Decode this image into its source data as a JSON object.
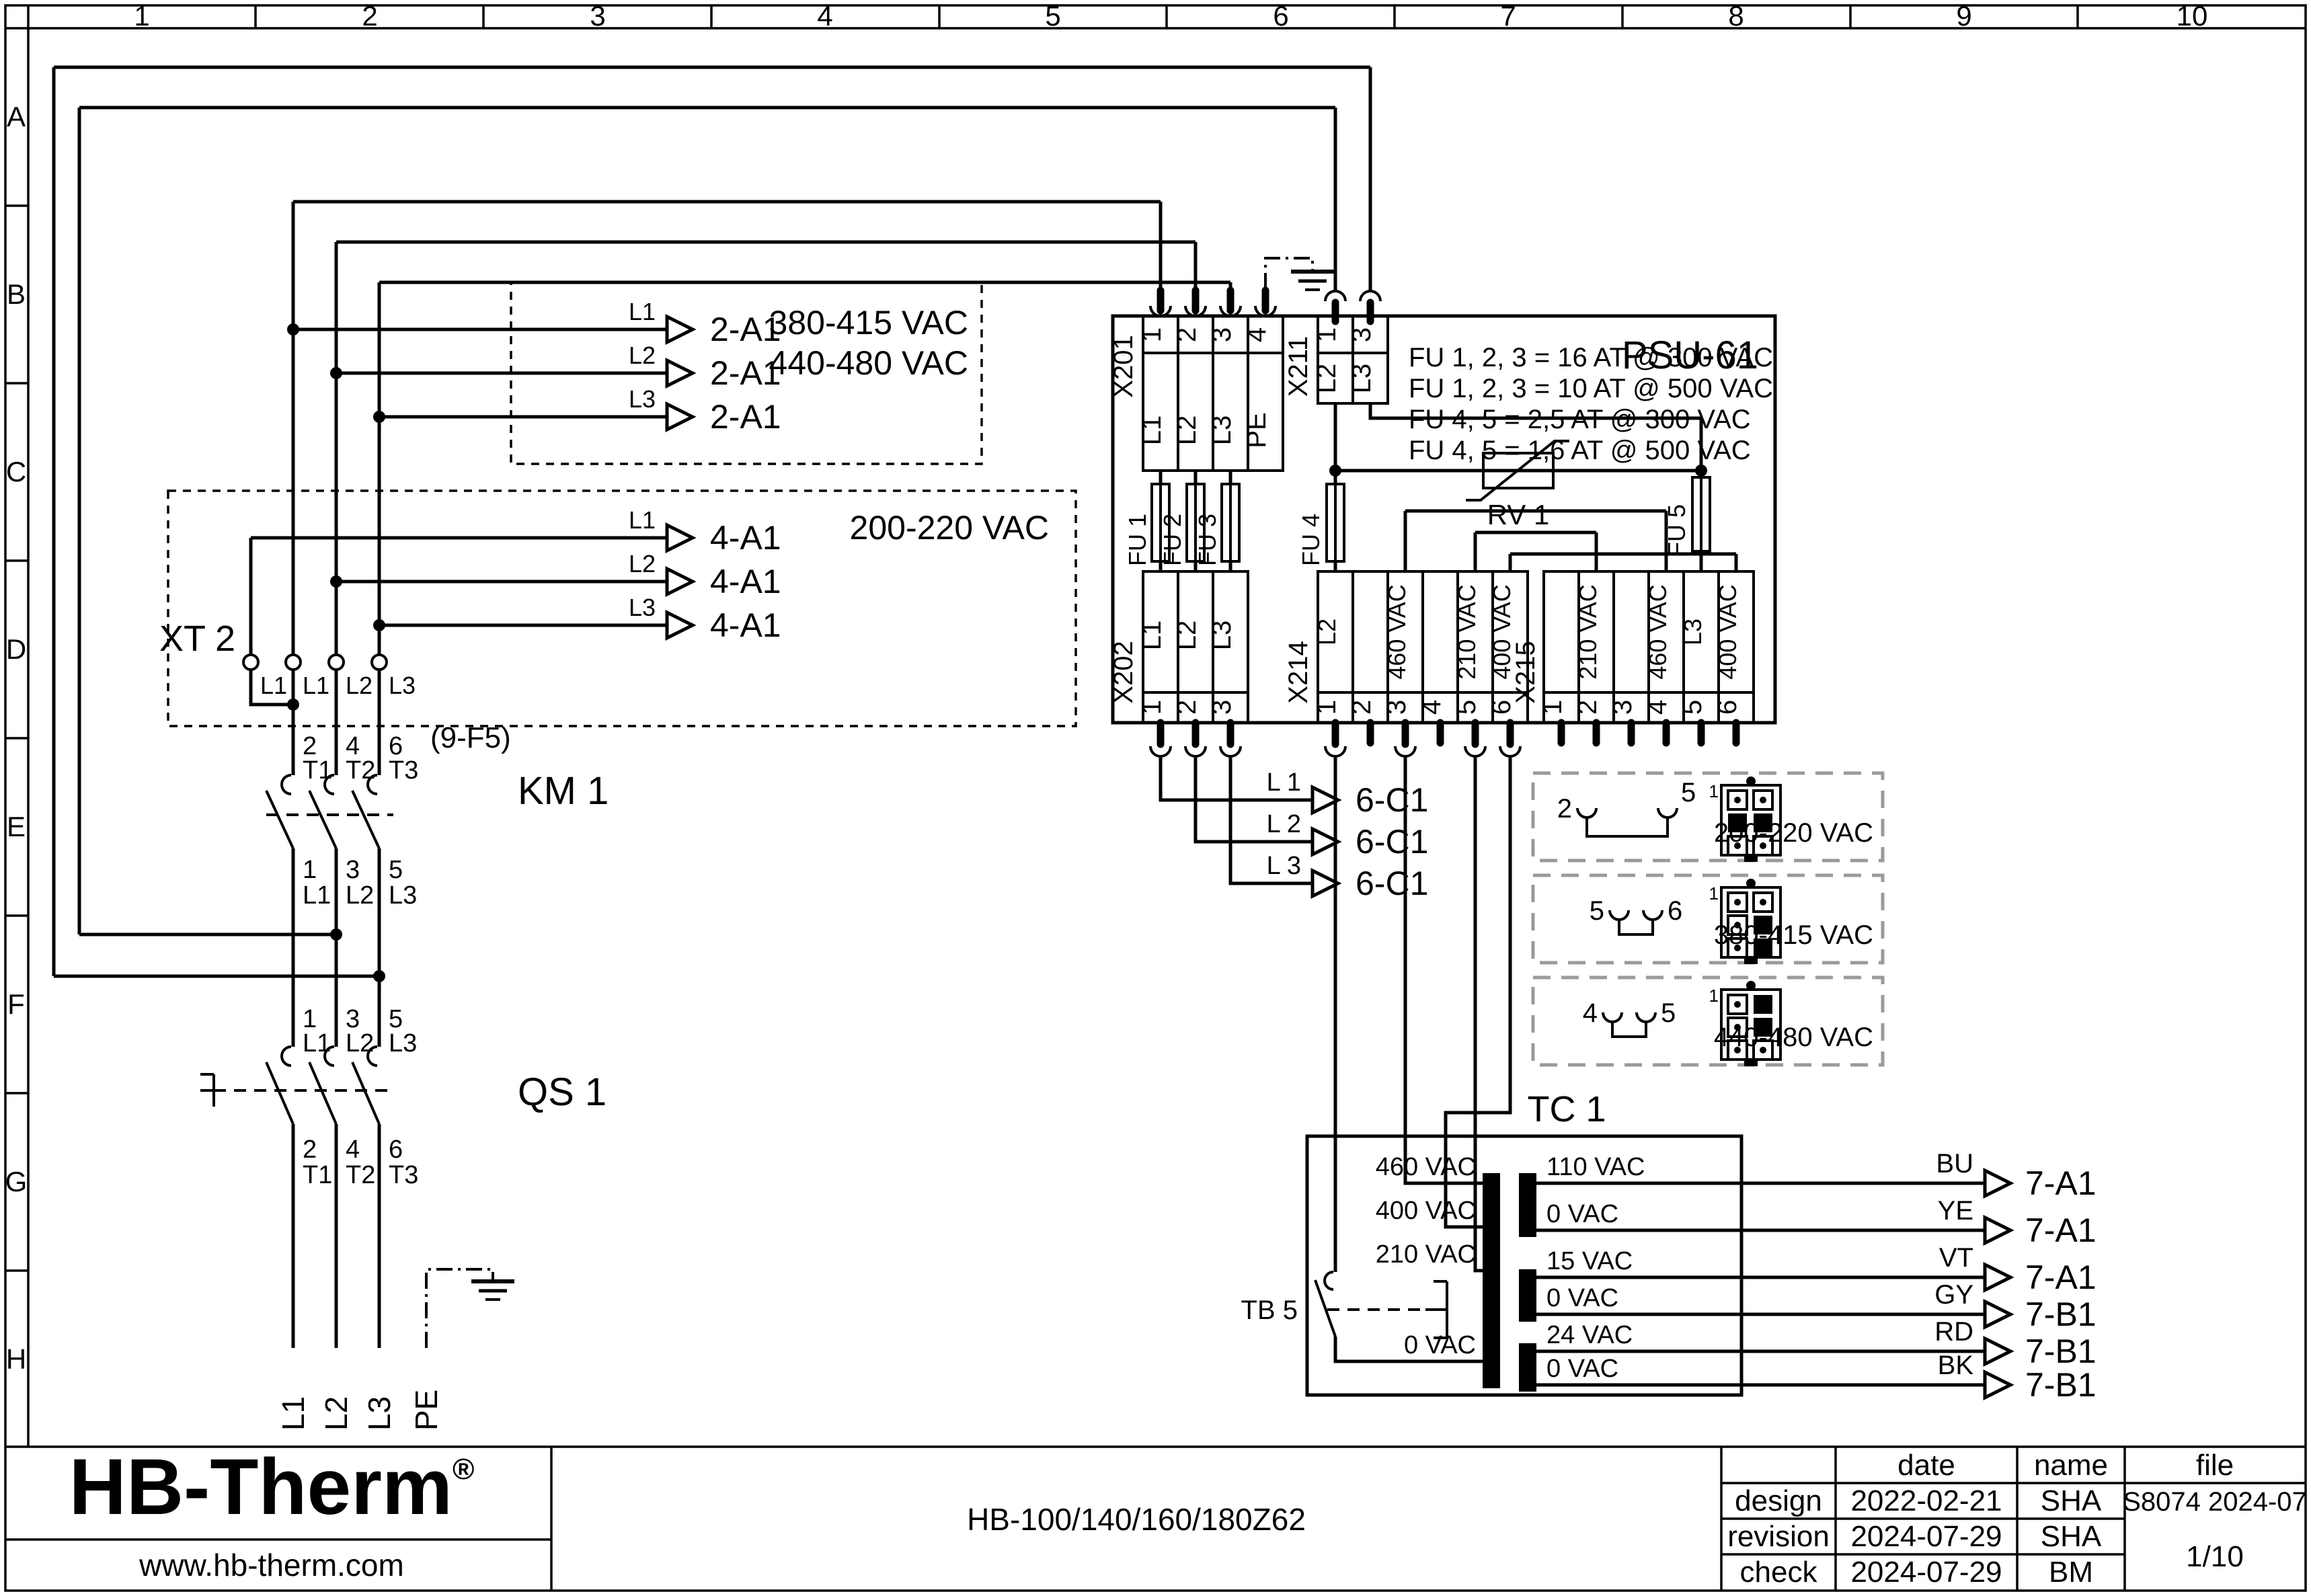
{
  "frame": {
    "columns": [
      "1",
      "2",
      "3",
      "4",
      "5",
      "6",
      "7",
      "8",
      "9",
      "10"
    ],
    "rows": [
      "A",
      "B",
      "C",
      "D",
      "E",
      "F",
      "G",
      "H"
    ]
  },
  "hv_box": {
    "line1": "380-415 VAC",
    "line2": "440-480 VAC",
    "wires": [
      {
        "label": "L1",
        "target": "2-A1"
      },
      {
        "label": "L2",
        "target": "2-A1"
      },
      {
        "label": "L3",
        "target": "2-A1"
      }
    ]
  },
  "lv_box": {
    "title": "200-220 VAC",
    "wires": [
      {
        "label": "L1",
        "target": "4-A1"
      },
      {
        "label": "L2",
        "target": "4-A1"
      },
      {
        "label": "L3",
        "target": "4-A1"
      }
    ]
  },
  "xt2": {
    "name": "XT 2",
    "terminals": [
      "L1",
      "L1",
      "L2",
      "L3"
    ]
  },
  "km1": {
    "name": "KM 1",
    "ref": "(9-F5)",
    "poles": [
      {
        "top_num": "2",
        "top": "T1",
        "bot_num": "1",
        "bot": "L1"
      },
      {
        "top_num": "4",
        "top": "T2",
        "bot_num": "3",
        "bot": "L2"
      },
      {
        "top_num": "6",
        "top": "T3",
        "bot_num": "5",
        "bot": "L3"
      }
    ]
  },
  "qs1": {
    "name": "QS 1",
    "poles": [
      {
        "top_num": "1",
        "top": "L1",
        "bot_num": "2",
        "bot": "T1"
      },
      {
        "top_num": "3",
        "top": "L2",
        "bot_num": "4",
        "bot": "T2"
      },
      {
        "top_num": "5",
        "top": "L3",
        "bot_num": "6",
        "bot": "T3"
      }
    ]
  },
  "incoming": {
    "phases": [
      "L1",
      "L2",
      "L3"
    ],
    "pe": "PE"
  },
  "psu": {
    "name": "PSU-61",
    "fuse_notes": [
      "FU 1, 2, 3 = 16 AT @ 300 VAC",
      "FU 1, 2, 3 = 10 AT @ 500 VAC",
      "FU 4, 5 = 2,5 AT @ 300 VAC",
      "FU 4, 5 = 1,6 AT @ 500 VAC"
    ],
    "x201": {
      "name": "X201",
      "pins": [
        "1",
        "2",
        "3",
        "4"
      ],
      "labels": [
        "L1",
        "L2",
        "L3",
        "PE"
      ]
    },
    "x211": {
      "name": "X211",
      "pins": [
        "1",
        "3"
      ],
      "labels": [
        "L2",
        "L3"
      ]
    },
    "x202": {
      "name": "X202",
      "pins": [
        "1",
        "2",
        "3"
      ],
      "labels": [
        "L1",
        "L2",
        "L3"
      ]
    },
    "x214": {
      "name": "X214",
      "pins": [
        "1",
        "2",
        "3",
        "4",
        "5",
        "6"
      ],
      "labels": [
        "L2",
        "",
        "460 VAC",
        "",
        "210 VAC",
        "400 VAC"
      ]
    },
    "x215": {
      "name": "X215",
      "pins": [
        "1",
        "2",
        "3",
        "4",
        "5",
        "6"
      ],
      "labels": [
        "",
        "210 VAC",
        "",
        "460 VAC",
        "L3",
        "400 VAC"
      ]
    },
    "fuses": [
      "FU 1",
      "FU 2",
      "FU 3",
      "FU 4",
      "FU 5"
    ],
    "rv1": "RV 1"
  },
  "c1_wires": [
    {
      "label": "L 1",
      "target": "6-C1"
    },
    {
      "label": "L 2",
      "target": "6-C1"
    },
    {
      "label": "L 3",
      "target": "6-C1"
    }
  ],
  "selectors": [
    {
      "pin1": "1",
      "jumper": [
        "2",
        "5"
      ],
      "voltage": "200-220 VAC"
    },
    {
      "pin1": "1",
      "jumper": [
        "5",
        "6"
      ],
      "voltage": "380-415 VAC"
    },
    {
      "pin1": "1",
      "jumper": [
        "4",
        "5"
      ],
      "voltage": "440-480 VAC"
    }
  ],
  "tc1": {
    "name": "TC 1",
    "tb5": "TB 5",
    "primary_taps": [
      "460 VAC",
      "400 VAC",
      "210 VAC",
      "0 VAC"
    ],
    "secondary": [
      {
        "tap": "110 VAC",
        "color": "BU",
        "target": "7-A1"
      },
      {
        "tap": "0 VAC",
        "color": "YE",
        "target": "7-A1"
      },
      {
        "tap": "15 VAC",
        "color": "VT",
        "target": "7-A1"
      },
      {
        "tap": "0 VAC",
        "color": "GY",
        "target": "7-B1"
      },
      {
        "tap": "24 VAC",
        "color": "RD",
        "target": "7-B1"
      },
      {
        "tap": "0 VAC",
        "color": "BK",
        "target": "7-B1"
      }
    ]
  },
  "title_block": {
    "logo": "HB-Therm",
    "logo_reg": "®",
    "website": "www.hb-therm.com",
    "doc_title": "HB-100/140/160/180Z62",
    "table": {
      "headers": [
        "date",
        "name",
        "file"
      ],
      "rows": [
        {
          "label": "design",
          "date": "2022-02-21",
          "name": "SHA",
          "file": "S8074 2024-07"
        },
        {
          "label": "revision",
          "date": "2024-07-29",
          "name": "SHA"
        },
        {
          "label": "check",
          "date": "2024-07-29",
          "name": "BM"
        }
      ],
      "page": "1/10"
    }
  },
  "colors": {
    "line": "#000000",
    "logo_navy": "#1e2a47",
    "selector_dash": "#9a9a9a"
  }
}
